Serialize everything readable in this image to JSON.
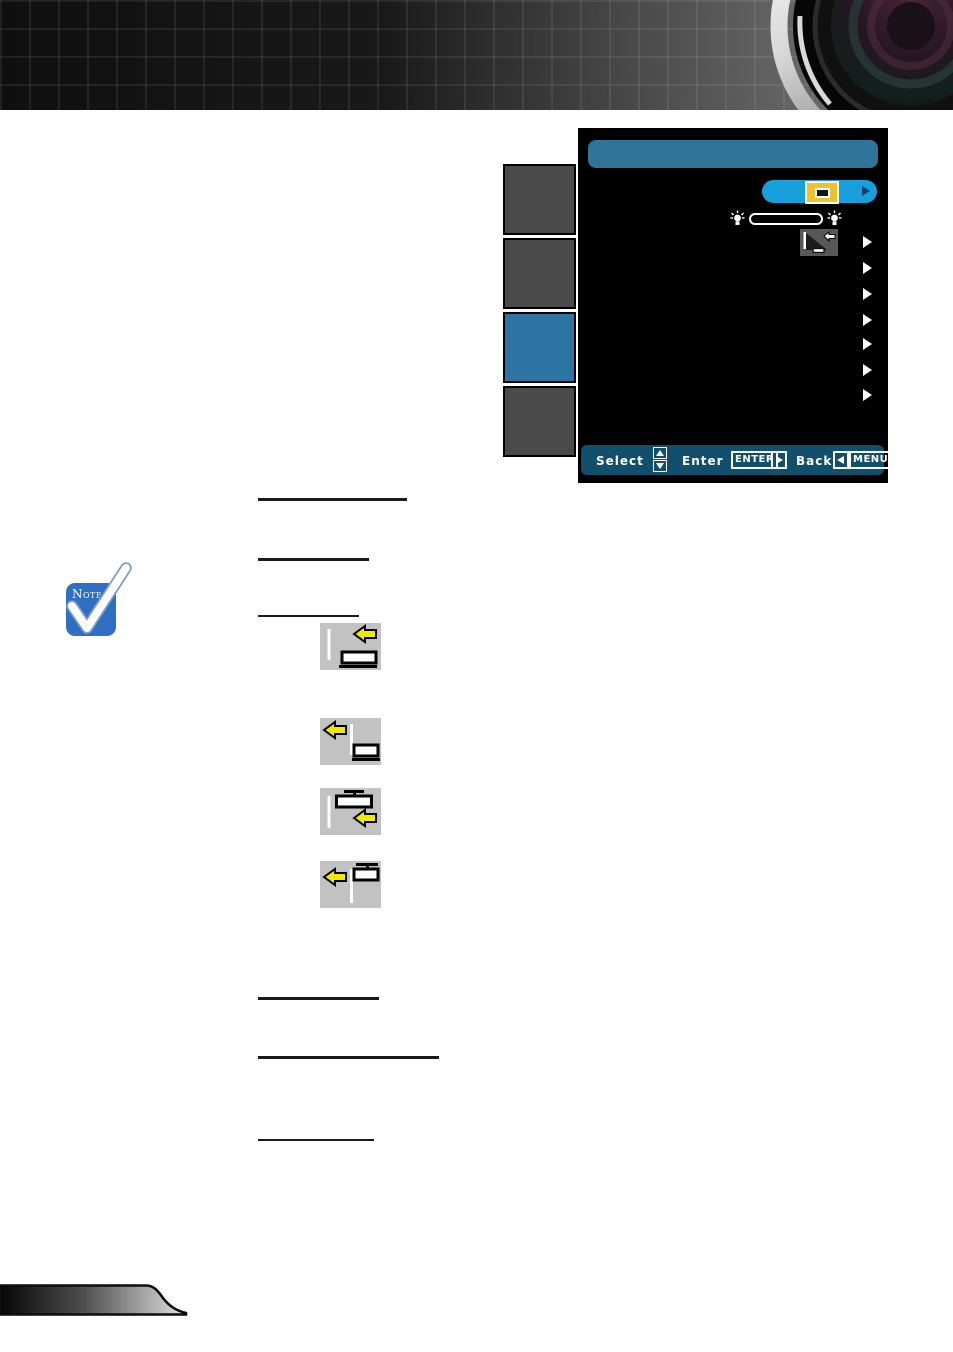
{
  "osd": {
    "title_text": "",
    "tabs": [
      {
        "id": "tab-1",
        "active": false
      },
      {
        "id": "tab-2",
        "active": false
      },
      {
        "id": "tab-3",
        "active": true
      },
      {
        "id": "tab-4",
        "active": false
      }
    ],
    "rows": {
      "highlighted_option": {
        "icon": "menu-location-icon",
        "has_arrow": true
      },
      "slider": {
        "left_icon": "lamp-icon",
        "right_icon": "lamp-icon",
        "fill_percent": 0
      },
      "projection_option": {
        "icon": "projection-mode-icon",
        "has_arrow": true
      },
      "plain_arrow_rows": 6
    },
    "footer": {
      "select": "Select",
      "enter": "Enter",
      "enter_key": "ENTER",
      "back": "Back",
      "menu_key": "MENU"
    },
    "colors": {
      "panel": "#000000",
      "title_bar": "#30749a",
      "footer_bar": "#114f6d",
      "tab_active": "#2d74a3",
      "tab_inactive": "#4a4a4a",
      "highlight_pill": "#18a0dc",
      "accent_yellow": "#ecc22d"
    }
  },
  "note": {
    "label": "Note",
    "color": "#2e6fc4"
  },
  "orientation_icons": [
    {
      "name": "front-desktop-icon"
    },
    {
      "name": "rear-desktop-icon"
    },
    {
      "name": "front-ceiling-icon"
    },
    {
      "name": "rear-ceiling-icon"
    }
  ],
  "decorations": {
    "header": "dark-grid-banner-with-projector-lens",
    "underline_rules": 6,
    "footer": "gradient-swoosh-ribbon",
    "arrow_yellow": "#f2ea00"
  }
}
